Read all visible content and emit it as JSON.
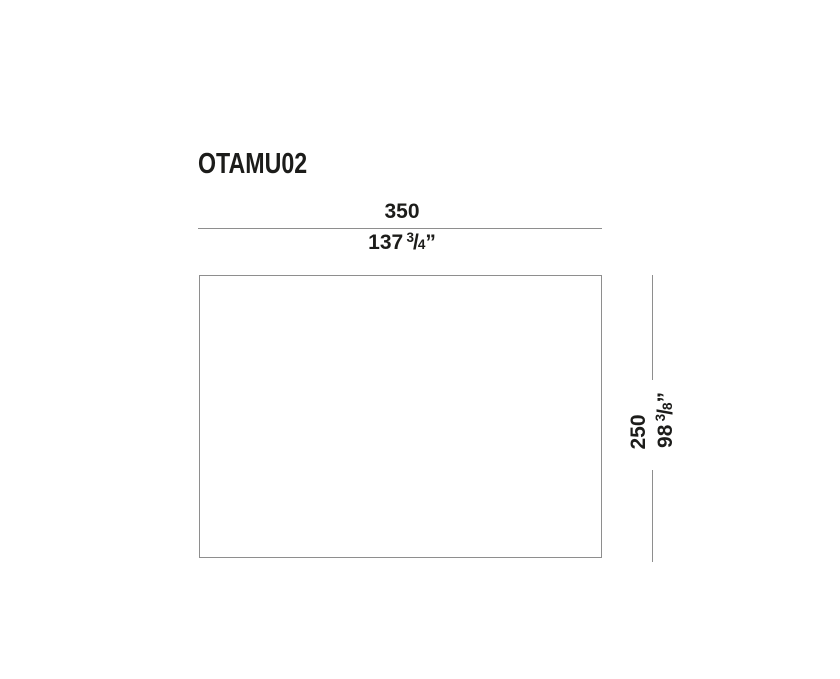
{
  "diagram": {
    "product_code": "OTAMU02",
    "width_dimension": {
      "metric": "350",
      "imperial_whole": "137",
      "imperial_numerator": "3",
      "imperial_slash": "/",
      "imperial_denominator": "4",
      "imperial_unit": "”"
    },
    "height_dimension": {
      "metric": "250",
      "imperial_whole": "98",
      "imperial_numerator": "3",
      "imperial_slash": "/",
      "imperial_denominator": "8",
      "imperial_unit": "”"
    },
    "colors": {
      "text": "#1c1c1a",
      "dimension_line": "#8e8e8e",
      "background": "#ffffff"
    }
  }
}
